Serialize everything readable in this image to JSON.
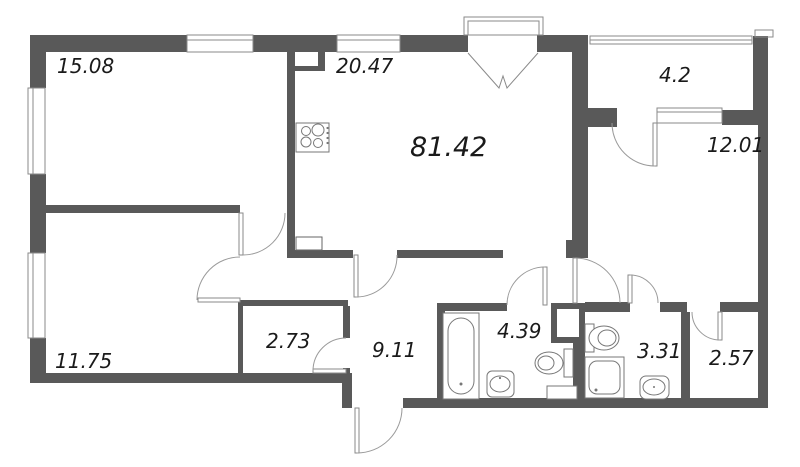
{
  "plan": {
    "total_area_label": "81.42",
    "room_labels": {
      "room_top_left": "15.08",
      "kitchen_living": "20.47",
      "loggia": "4.2",
      "bedroom_right": "12.01",
      "room_bottom_left": "11.75",
      "closet": "2.73",
      "corridor": "9.11",
      "bathroom": "4.39",
      "wc": "3.31",
      "wardrobe": "2.57"
    },
    "colors": {
      "wall": "#595959",
      "background": "#ffffff",
      "door_arc": "#9a9a9a",
      "fixture_outline": "#777777",
      "text": "#1a1a1a"
    }
  }
}
